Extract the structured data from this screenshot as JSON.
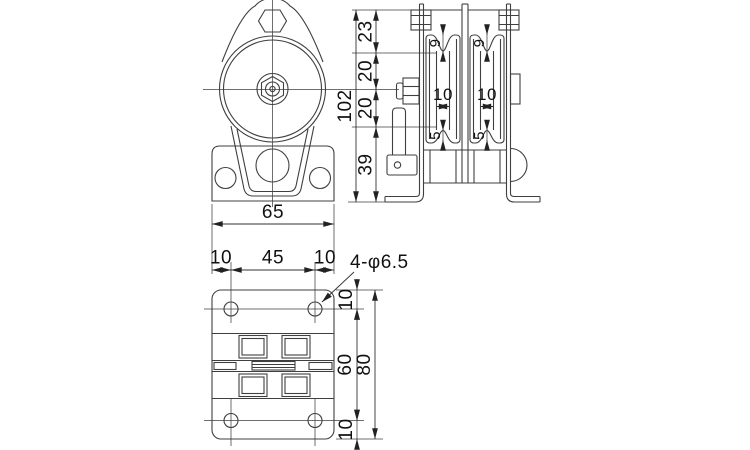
{
  "drawing_name": "double-sheave-pulley-three-view-drawing",
  "colors": {
    "background": "#ffffff",
    "line": "#3f3f3f",
    "dim": "#333333",
    "text": "#111111"
  },
  "dims": {
    "front": {
      "base_width": "65"
    },
    "side": {
      "overall_height": "102",
      "top": "23",
      "upper_mid": "20",
      "lower_mid": "20",
      "bottom": "39",
      "groove_depth": "9",
      "groove_width": "10",
      "flange": "5"
    },
    "plan": {
      "edge_left": "10",
      "hole_span": "45",
      "edge_right": "10",
      "holes_label": "4-φ6.5",
      "top_offset": "10",
      "hole_pitch": "60",
      "overall_depth": "80",
      "bottom_offset": "10"
    }
  }
}
